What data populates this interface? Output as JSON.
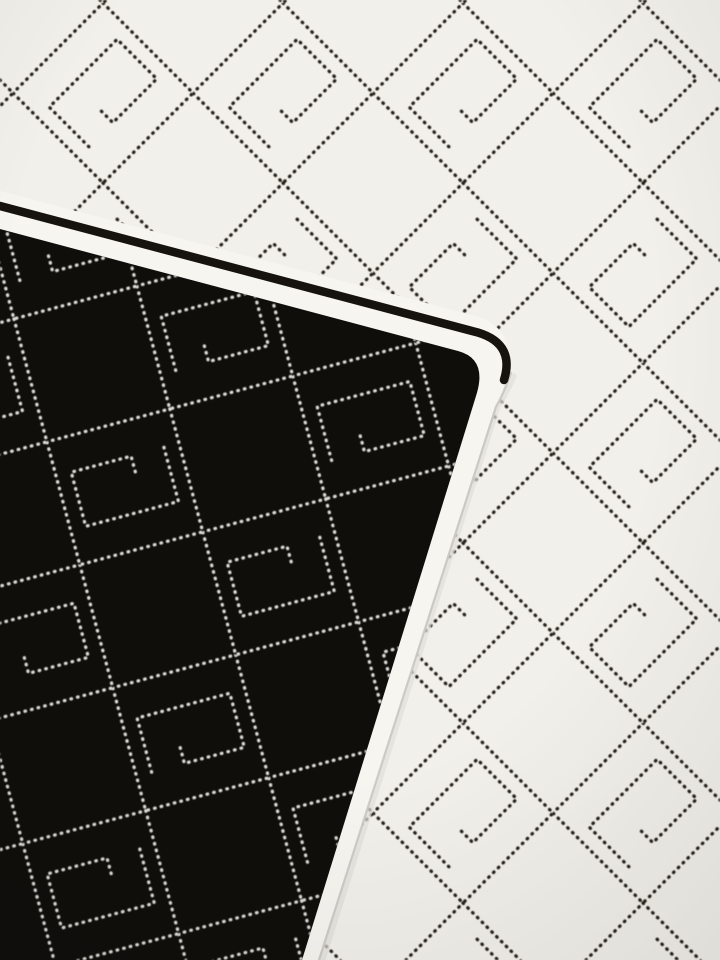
{
  "scene": {
    "type": "product-photo",
    "subject": "Reversible black and white knitted jacquard scarf, corner folded over",
    "description": "Close-up photo of a knitted jacquard fabric: the white side shows a black dotted-stitch diamond lattice with open-rectangle monogram-G motifs in alternating diamonds; a folded corner in the lower left reveals the black reverse side with the same pattern stitched in white; the fold edge is finished with a thin black piping line and a clean white trim band, and a faint seam shadow runs along the right edge of the folded layer."
  },
  "colors": {
    "white_fabric": "#f2f0ea",
    "band_white": "#f7f5f0",
    "black_fabric": "#0f0e0b",
    "stitch_dark": "#26231e",
    "stitch_light": "#dedcd7",
    "piping_black": "#16130e",
    "seam_shadow": "#c6c4bf",
    "seam_soft": "#e0ded9",
    "vignette": "#141210"
  },
  "pattern": {
    "name": "diamond lattice with monogram-G motifs",
    "stitch_style": "dotted running stitch",
    "tile_px": 180,
    "white_area_angle_deg": 45,
    "black_area_angle_deg": 75,
    "motif": "open rotated rectangle with inner hook, alternating 180-degree orientation per row",
    "motif_long_px": 96,
    "motif_short_px": 56
  },
  "fold": {
    "piping_width_px": 8,
    "band_width_px": 18,
    "top_edge_angle_deg": 15,
    "corner_x": 505,
    "corner_y": 355
  }
}
